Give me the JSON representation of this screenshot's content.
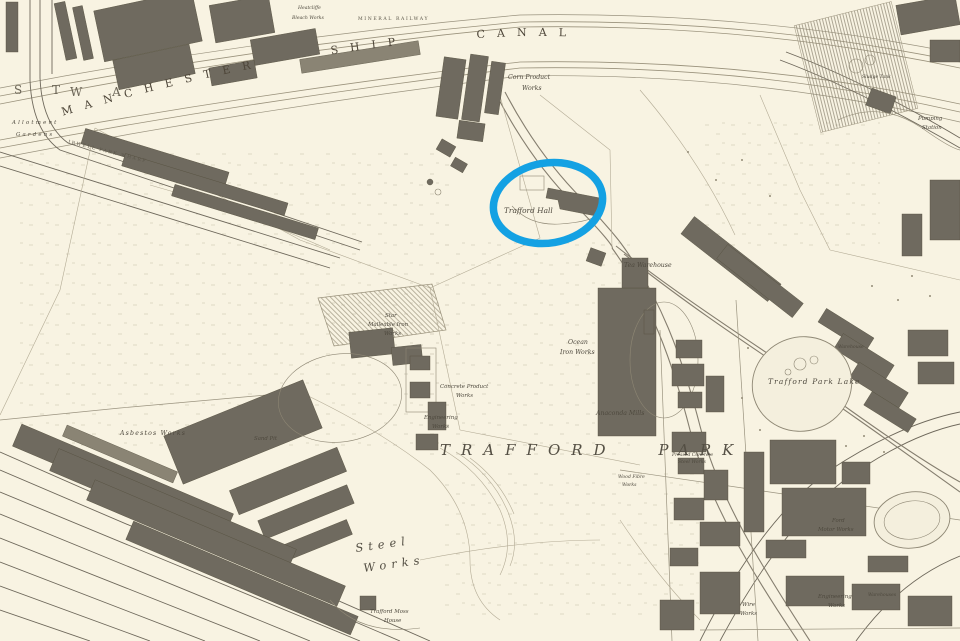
{
  "map": {
    "paper_color": "#f8f3e2",
    "ink_color": "#4e493e",
    "building_color": "#6f6a5f",
    "highlight": {
      "shape": "ellipse",
      "color": "#14a1e3",
      "target_label": "Trafford Hall"
    },
    "labels": [
      {
        "id": "ship-canal",
        "text": "MANCHESTER SHIP CANAL"
      },
      {
        "id": "trafford-park",
        "text": "TRAFFORD PARK"
      },
      {
        "id": "trafford-hall",
        "text": "Trafford Hall"
      },
      {
        "id": "corn-product-1",
        "text": "Corn Product"
      },
      {
        "id": "corn-product-2",
        "text": "Works"
      },
      {
        "id": "tea-warehouse",
        "text": "Tea Warehouse"
      },
      {
        "id": "ocean-iron-1",
        "text": "Ocean"
      },
      {
        "id": "ocean-iron-2",
        "text": "Iron Works"
      },
      {
        "id": "anaconda-mills",
        "text": "Anaconda Mills"
      },
      {
        "id": "star-malleable-1",
        "text": "Star"
      },
      {
        "id": "star-malleable-2",
        "text": "Malleable Iron"
      },
      {
        "id": "star-malleable-3",
        "text": "Works"
      },
      {
        "id": "concrete-product-1",
        "text": "Concrete Product"
      },
      {
        "id": "concrete-product-2",
        "text": "Works"
      },
      {
        "id": "engineering-w-1",
        "text": "Engineering"
      },
      {
        "id": "engineering-w-2",
        "text": "Works"
      },
      {
        "id": "asbestos-works",
        "text": "Asbestos Works"
      },
      {
        "id": "sand-pit",
        "text": "Sand Pit"
      },
      {
        "id": "trafford-park-lake",
        "text": "Trafford Park Lake"
      },
      {
        "id": "warehouse-ne-lake",
        "text": "Warehouse"
      },
      {
        "id": "ford-1",
        "text": "Ford"
      },
      {
        "id": "ford-2",
        "text": "Motor Works"
      },
      {
        "id": "engineering-se-1",
        "text": "Engineering"
      },
      {
        "id": "engineering-se-2",
        "text": "Works"
      },
      {
        "id": "wire-works-1",
        "text": "Wire"
      },
      {
        "id": "wire-works-2",
        "text": "Works"
      },
      {
        "id": "steel-works-1",
        "text": "Steel"
      },
      {
        "id": "steel-works-2",
        "text": "Works"
      },
      {
        "id": "moss-house-1",
        "text": "Trafford Moss"
      },
      {
        "id": "moss-house-2",
        "text": "House"
      },
      {
        "id": "pumping-1",
        "text": "Pumping"
      },
      {
        "id": "pumping-2",
        "text": "Station"
      },
      {
        "id": "allotment-1",
        "text": "Allotment"
      },
      {
        "id": "allotment-2",
        "text": "Gardens"
      },
      {
        "id": "irwell-wharf",
        "text": "IRWELL PARK WHARF"
      },
      {
        "id": "bleach-1",
        "text": "Heatcliffe"
      },
      {
        "id": "bleach-2",
        "text": "Bleach Works"
      },
      {
        "id": "ward-st",
        "text": "S T"
      },
      {
        "id": "ward-wa",
        "text": "W A"
      },
      {
        "id": "wood-fibre-1",
        "text": "Wood Fibre"
      },
      {
        "id": "wood-fibre-2",
        "text": "Works"
      },
      {
        "id": "sludge-tank",
        "text": "Sludge Tank"
      },
      {
        "id": "warehouses-se",
        "text": "Warehouses"
      },
      {
        "id": "pressed-1",
        "text": "Pressed Concrete"
      },
      {
        "id": "pressed-2",
        "text": "Steel Works"
      },
      {
        "id": "mineral-railway",
        "text": "MINERAL RAILWAY"
      }
    ]
  }
}
